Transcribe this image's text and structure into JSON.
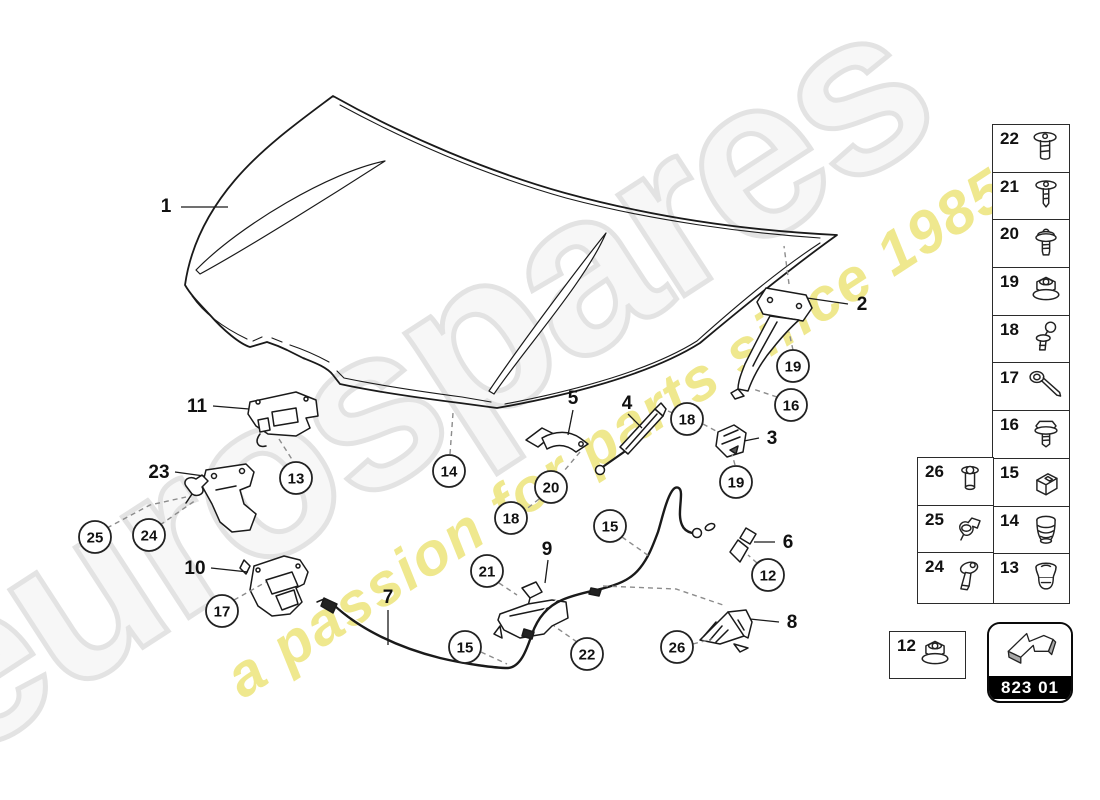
{
  "watermark": {
    "brand": "eurospares",
    "tagline": "a passion for parts since 1985",
    "brand_color": "#e3e3e3",
    "tagline_color": "#efe88e"
  },
  "diagram": {
    "part_labels": [
      {
        "n": "1",
        "x": 166,
        "y": 212
      },
      {
        "n": "11",
        "x": 197,
        "y": 412
      },
      {
        "n": "23",
        "x": 159,
        "y": 478
      },
      {
        "n": "10",
        "x": 195,
        "y": 574
      },
      {
        "n": "7",
        "x": 388,
        "y": 603
      },
      {
        "n": "5",
        "x": 573,
        "y": 404
      },
      {
        "n": "4",
        "x": 627,
        "y": 409
      },
      {
        "n": "9",
        "x": 547,
        "y": 555
      },
      {
        "n": "2",
        "x": 862,
        "y": 310
      },
      {
        "n": "3",
        "x": 772,
        "y": 444
      },
      {
        "n": "6",
        "x": 788,
        "y": 548
      },
      {
        "n": "8",
        "x": 792,
        "y": 628
      }
    ],
    "callouts": [
      {
        "n": "13",
        "x": 296,
        "y": 478
      },
      {
        "n": "17",
        "x": 222,
        "y": 611
      },
      {
        "n": "25",
        "x": 95,
        "y": 537
      },
      {
        "n": "24",
        "x": 149,
        "y": 535
      },
      {
        "n": "14",
        "x": 449,
        "y": 471
      },
      {
        "n": "20",
        "x": 551,
        "y": 487
      },
      {
        "n": "18",
        "x": 511,
        "y": 518
      },
      {
        "n": "21",
        "x": 487,
        "y": 571
      },
      {
        "n": "15",
        "x": 610,
        "y": 526
      },
      {
        "n": "15",
        "x": 465,
        "y": 647
      },
      {
        "n": "22",
        "x": 587,
        "y": 654
      },
      {
        "n": "26",
        "x": 677,
        "y": 647
      },
      {
        "n": "12",
        "x": 768,
        "y": 575
      },
      {
        "n": "18",
        "x": 687,
        "y": 419
      },
      {
        "n": "19",
        "x": 793,
        "y": 366
      },
      {
        "n": "16",
        "x": 791,
        "y": 405
      },
      {
        "n": "19",
        "x": 736,
        "y": 482
      }
    ]
  },
  "legend": {
    "main_column": [
      {
        "n": "22",
        "icon": "push-rivet-icon"
      },
      {
        "n": "21",
        "icon": "washer-screw-icon"
      },
      {
        "n": "20",
        "icon": "shoulder-screw-icon"
      },
      {
        "n": "19",
        "icon": "flange-nut-icon"
      },
      {
        "n": "18",
        "icon": "ball-stud-icon"
      },
      {
        "n": "17",
        "icon": "eye-bolt-icon"
      },
      {
        "n": "16",
        "icon": "hex-bolt-icon"
      },
      {
        "n": "15",
        "icon": "clip-icon"
      },
      {
        "n": "14",
        "icon": "rubber-buffer-icon"
      },
      {
        "n": "13",
        "icon": "grommet-icon"
      }
    ],
    "side_column": [
      {
        "n": "26",
        "icon": "rivnut-icon"
      },
      {
        "n": "25",
        "icon": "retainer-clip-icon"
      },
      {
        "n": "24",
        "icon": "push-pin-icon"
      }
    ],
    "nut_box": {
      "n": "12",
      "icon": "flange-nut-icon"
    },
    "code_badge": {
      "code": "823 01",
      "icon": "arrow-icon"
    }
  }
}
